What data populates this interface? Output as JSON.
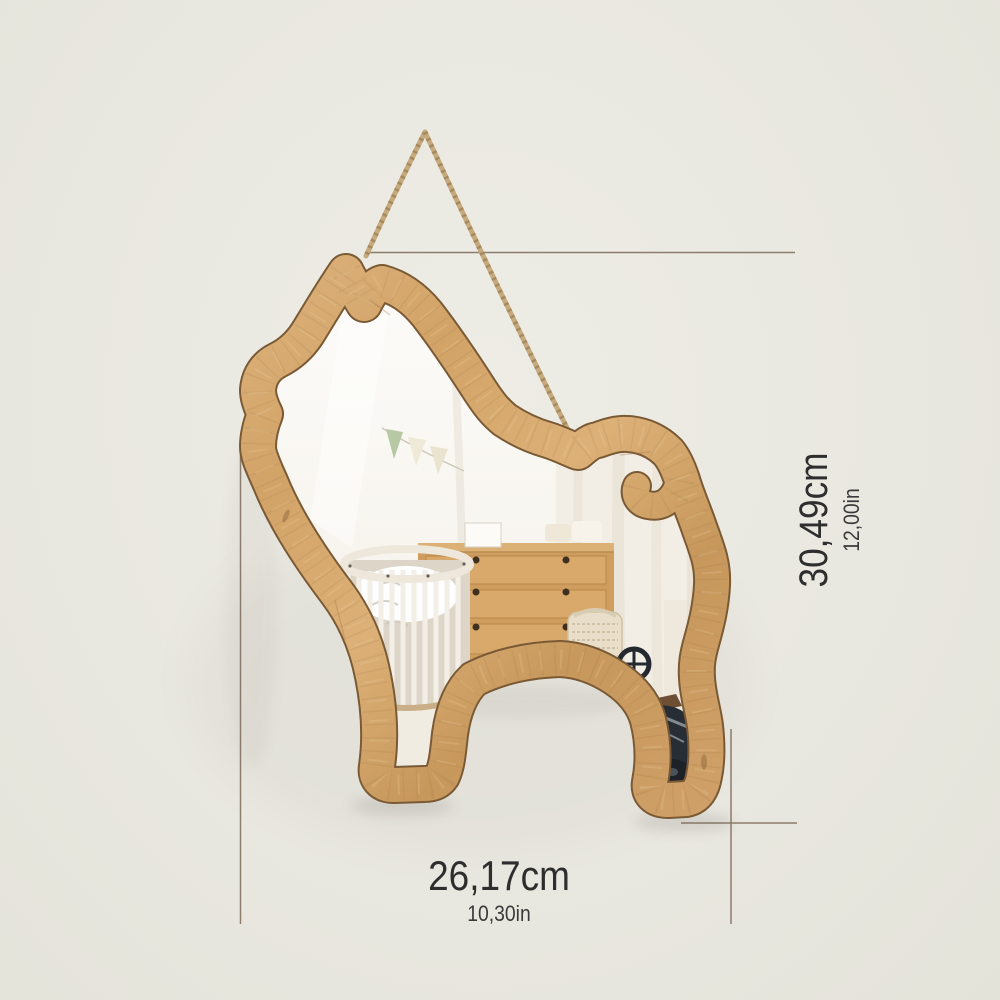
{
  "scene": {
    "description": "Wooden chihuahua dog silhouette wall mirror hanging from a jute rope, reflecting a nursery room",
    "background_color": "#e9e8e0",
    "dimension_line_color": "#8d7d6d",
    "label_text_color": "#2e2e2e",
    "wood_color": "#d2a367",
    "wood_edge_color": "#7a5a35",
    "rope_color": "#c6aa7e",
    "mirror_color": "#fbf9f4"
  },
  "labels": {
    "height_cm": "30,49cm",
    "height_in": "12,00in",
    "width_cm": "26,17cm",
    "width_in": "10,30in"
  },
  "reflection_items": [
    "pennant-banner",
    "round-white-crib",
    "wooden-dresser",
    "woven-basket",
    "toy-scooter",
    "curtain"
  ]
}
